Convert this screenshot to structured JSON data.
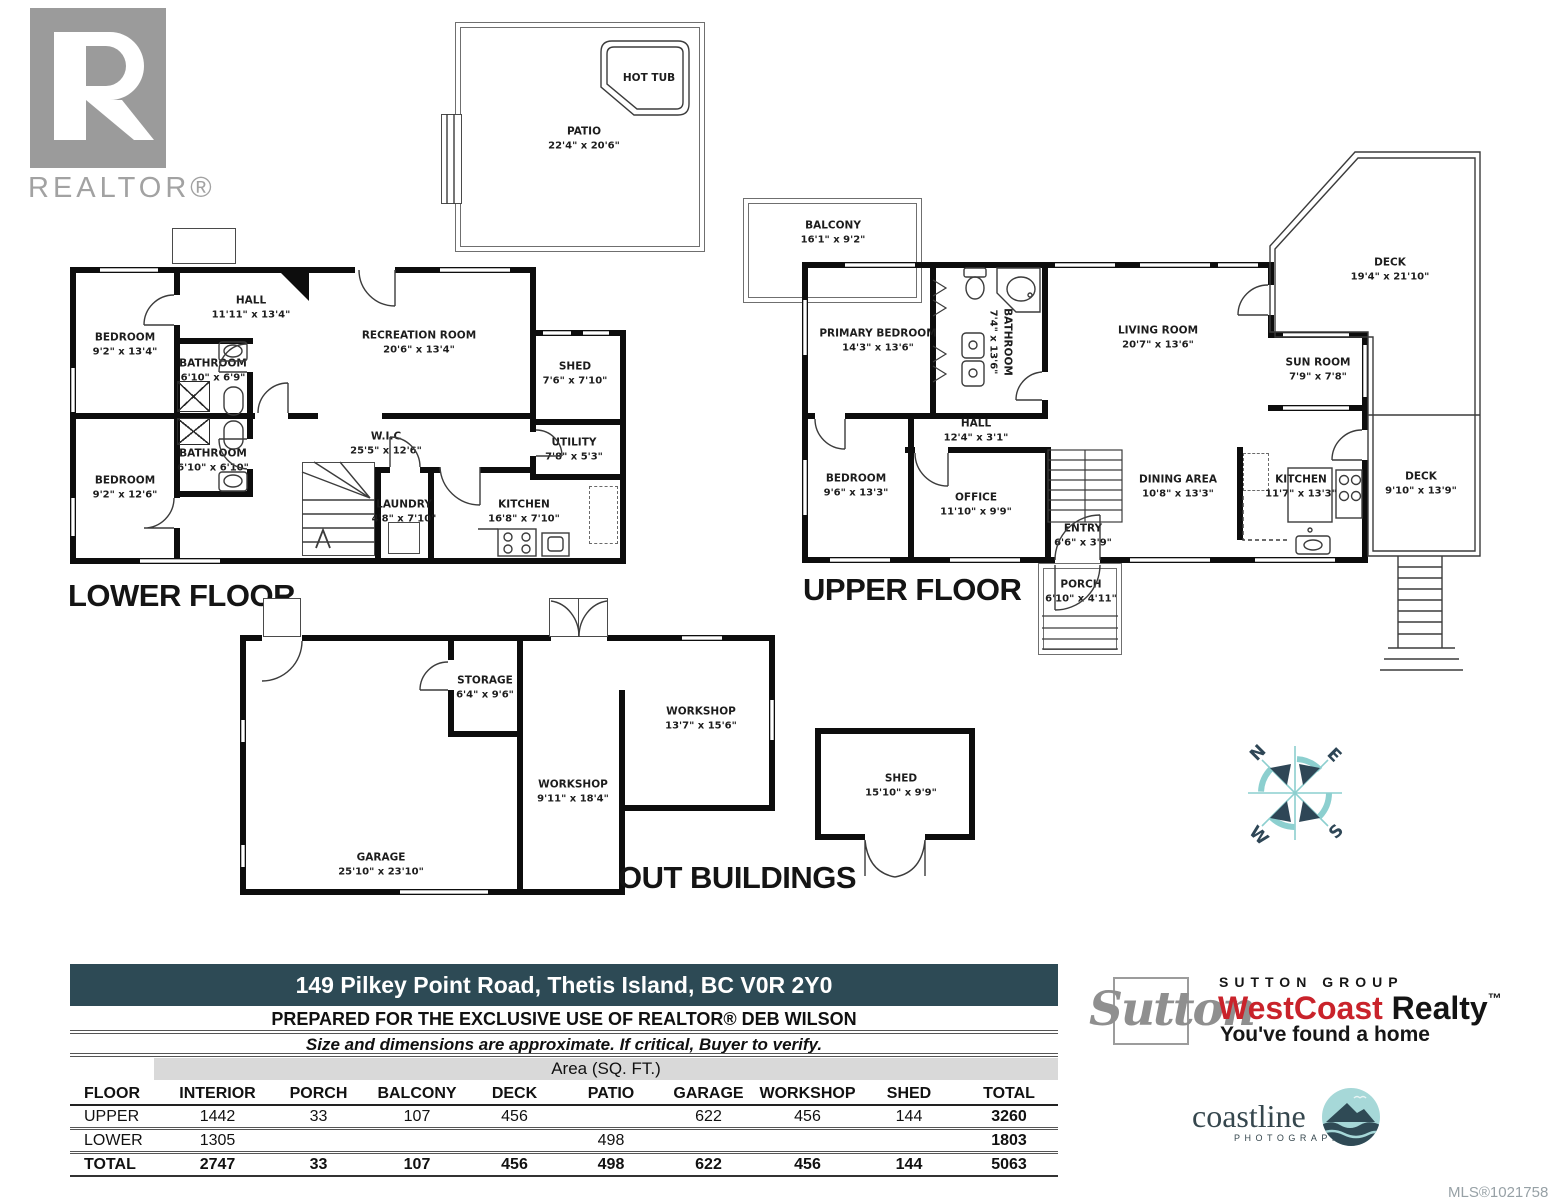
{
  "branding": {
    "realtor": "REALTOR®",
    "mls": "MLS®1021758",
    "sutton": {
      "script": "Sutton",
      "group": "SUTTON GROUP",
      "brand_red": "WestCoast",
      "brand_black": " Realty",
      "tm": "™",
      "tagline": "You've found a home"
    },
    "coastline": {
      "name": "coastline",
      "sub": "PHOTOGRAPHY"
    }
  },
  "titles": {
    "lower": "LOWER FLOOR",
    "upper": "UPPER FLOOR",
    "out": "OUT BUILDINGS"
  },
  "compass": {
    "n": "N",
    "e": "E",
    "s": "S",
    "w": "W"
  },
  "colors": {
    "wall": "#0d0d0d",
    "accent_bar": "#2d4a55",
    "brand_red": "#c9232b",
    "compass_navy": "#2e4656",
    "compass_teal": "#8ccfcf"
  },
  "rooms": {
    "pa_patio": {
      "name": "PATIO",
      "dims": "22'4\" x 20'6\""
    },
    "pa_hottub": {
      "name": "HOT TUB",
      "dims": ""
    },
    "lf_bed1": {
      "name": "BEDROOM",
      "dims": "9'2\" x 13'4\""
    },
    "lf_hall": {
      "name": "HALL",
      "dims": "11'11\" x 13'4\""
    },
    "lf_rec": {
      "name": "RECREATION ROOM",
      "dims": "20'6\" x 13'4\""
    },
    "lf_bath1": {
      "name": "BATHROOM",
      "dims": "6'10\" x 6'9\""
    },
    "lf_bath2": {
      "name": "BATHROOM",
      "dims": "6'10\" x 6'10\""
    },
    "lf_bed2": {
      "name": "BEDROOM",
      "dims": "9'2\" x 12'6\""
    },
    "lf_wic": {
      "name": "W.I.C",
      "dims": "25'5\" x 12'6\""
    },
    "lf_shed": {
      "name": "SHED",
      "dims": "7'6\" x 7'10\""
    },
    "lf_utility": {
      "name": "UTILITY",
      "dims": "7'8\" x 5'3\""
    },
    "lf_laundry": {
      "name": "LAUNDRY",
      "dims": "4'8\" x 7'10\""
    },
    "lf_kitchen": {
      "name": "KITCHEN",
      "dims": "16'8\" x 7'10\""
    },
    "uf_balcony": {
      "name": "BALCONY",
      "dims": "16'1\" x 9'2\""
    },
    "uf_primary": {
      "name": "PRIMARY BEDROOM",
      "dims": "14'3\" x 13'6\""
    },
    "uf_bath": {
      "name": "BATHROOM",
      "dims": "7'4\" x 13'6\""
    },
    "uf_living": {
      "name": "LIVING ROOM",
      "dims": "20'7\" x 13'6\""
    },
    "uf_deck1": {
      "name": "DECK",
      "dims": "19'4\" x 21'10\""
    },
    "uf_sun": {
      "name": "SUN ROOM",
      "dims": "7'9\" x 7'8\""
    },
    "uf_deck2": {
      "name": "DECK",
      "dims": "9'10\" x 13'9\""
    },
    "uf_hall": {
      "name": "HALL",
      "dims": "12'4\" x 3'1\""
    },
    "uf_bed": {
      "name": "BEDROOM",
      "dims": "9'6\" x 13'3\""
    },
    "uf_office": {
      "name": "OFFICE",
      "dims": "11'10\" x 9'9\""
    },
    "uf_entry": {
      "name": "ENTRY",
      "dims": "6'6\" x 3'9\""
    },
    "uf_porch": {
      "name": "PORCH",
      "dims": "6'10\" x 4'11\""
    },
    "uf_dining": {
      "name": "DINING AREA",
      "dims": "10'8\" x 13'3\""
    },
    "uf_kitchen": {
      "name": "KITCHEN",
      "dims": "11'7\" x 13'3\""
    },
    "ob_garage": {
      "name": "GARAGE",
      "dims": "25'10\" x 23'10\""
    },
    "ob_storage": {
      "name": "STORAGE",
      "dims": "6'4\" x 9'6\""
    },
    "ob_ws1": {
      "name": "WORKSHOP",
      "dims": "9'11\" x 18'4\""
    },
    "ob_ws2": {
      "name": "WORKSHOP",
      "dims": "13'7\" x 15'6\""
    },
    "ob_shed": {
      "name": "SHED",
      "dims": "15'10\" x 9'9\""
    }
  },
  "footer": {
    "address": "149 Pilkey Point Road, Thetis Island, BC V0R 2Y0",
    "prepared_prefix": "PREPARED FOR THE EXCLUSIVE USE OF REALTOR® ",
    "prepared_name": "DEB WILSON",
    "disclaimer": "Size and dimensions are approximate. If critical, Buyer to verify.",
    "table": {
      "title": "Area (SQ. FT.)",
      "headers": [
        "FLOOR",
        "INTERIOR",
        "PORCH",
        "BALCONY",
        "DECK",
        "PATIO",
        "GARAGE",
        "WORKSHOP",
        "SHED",
        "TOTAL"
      ],
      "rows": [
        {
          "label": "UPPER",
          "values": [
            "1442",
            "33",
            "107",
            "456",
            "",
            "622",
            "456",
            "144",
            "3260"
          ]
        },
        {
          "label": "LOWER",
          "values": [
            "1305",
            "",
            "",
            "",
            "498",
            "",
            "",
            "",
            "1803"
          ]
        },
        {
          "label": "TOTAL",
          "values": [
            "2747",
            "33",
            "107",
            "456",
            "498",
            "622",
            "456",
            "144",
            "5063"
          ]
        }
      ]
    }
  }
}
